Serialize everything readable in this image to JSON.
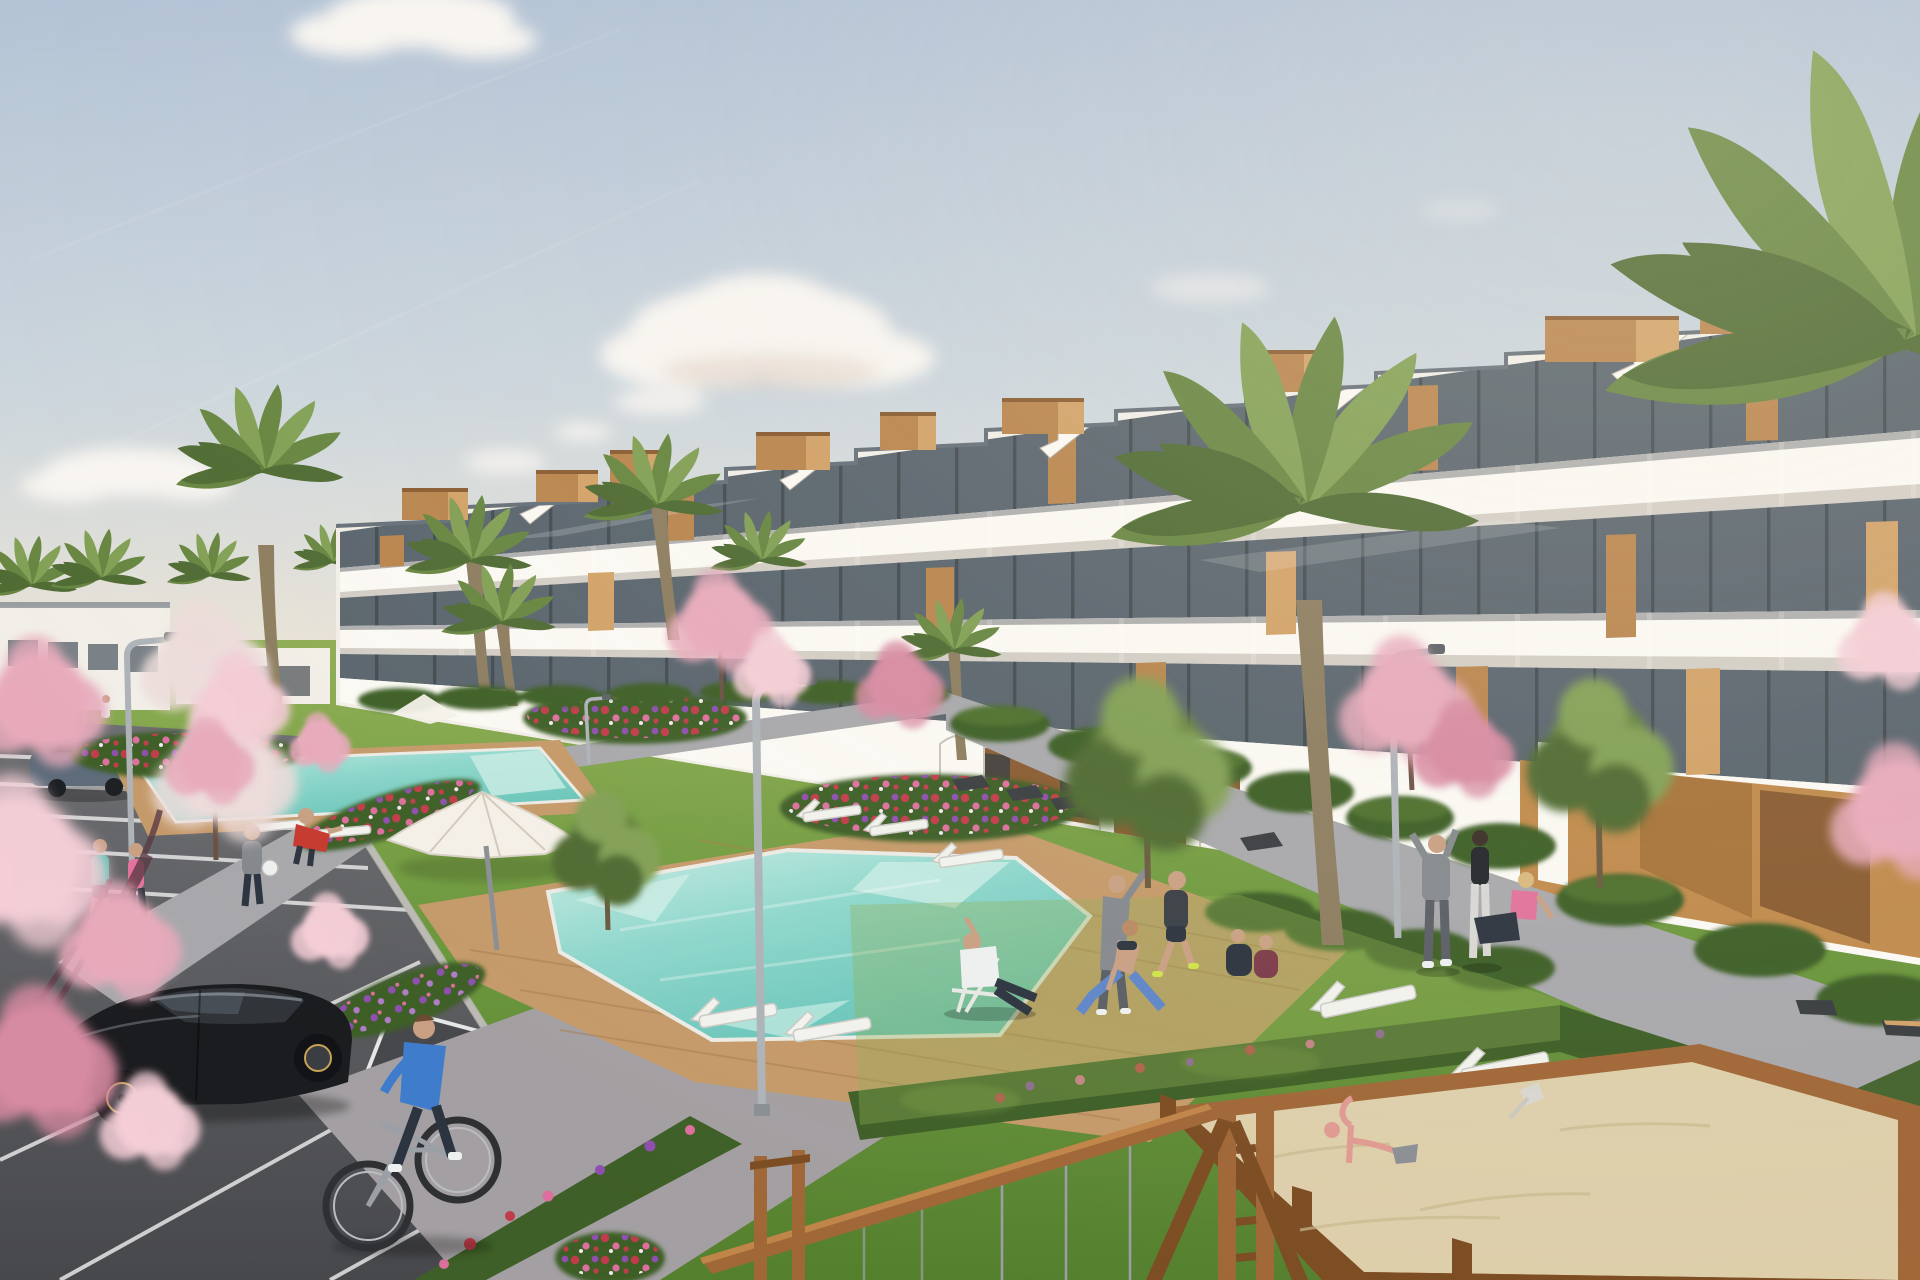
{
  "scene": {
    "type": "architectural-render",
    "objects": {
      "sky": "Clear morning sky",
      "clouds": "Scattered soft clouds",
      "apartments": "White terraced apartment complex with wooden accents",
      "left_buildings": "Distant low residential block",
      "palms": "Palm trees",
      "blossoms": "Pink blossom trees",
      "green_trees": "Garden trees",
      "lawn": "Landscaped lawns",
      "flower_beds": "Flower beds in bloom",
      "hedges": "Trimmed hedges",
      "pool_main": "Main swimming pool",
      "pool_upper": "Second swimming pool",
      "deck": "Wooden pool deck",
      "loungers": "White sun loungers",
      "parasol": "White garden parasol",
      "lamps": "Curved street lamps",
      "benches": "Modern garden benches",
      "promenade": "Pedestrian promenade",
      "plaza": "Paved plaza",
      "parking": "Residents parking lot",
      "black_car": "Black hatchback car",
      "parked_cars": "Parked cars",
      "cyclist": "Man riding a bicycle",
      "joggers": "Two women jogging",
      "ball_players": "Residents playing with a ball",
      "yoga_group": "Residents exercising on the lawn",
      "pool_sitter": "Man relaxing on a deck chair",
      "walkers": "Residents on the promenade",
      "sandbox": "Playground sandbox with toys",
      "swing": "Wooden swing frame",
      "foreground_blossom": "Foreground cherry blossom branches"
    }
  },
  "palette": {
    "sky_top": "#b3c3d6",
    "sky_mid": "#ccd6dd",
    "sky_low": "#e8e3d8",
    "cloud": "#f8f5f1",
    "bld_white": "#f2efe8",
    "bld_white_lit": "#fbf9f4",
    "bld_shadow": "#d9d4cb",
    "bld_deep": "#b2aca1",
    "glass_dark": "#343a40",
    "glass_mid": "#5a656e",
    "glass_lite": "#8b99a3",
    "wood": "#b9854e",
    "wood_lite": "#d2a268",
    "wood_dark": "#8a5c31",
    "roof_edge": "#66707a",
    "tan_wall": "#c08a4c",
    "tan_wall_dark": "#9c6b33",
    "palm_dark": "#4f6b33",
    "palm_mid": "#678641",
    "palm_lite": "#82a055",
    "trunk": "#8d7d60",
    "grass_lite": "#8fae54",
    "grass": "#6f9a3f",
    "grass_dark": "#54802e",
    "hedge": "#3e5f27",
    "hedge_lite": "#5d8136",
    "blossom": "#e7aabb",
    "blossom_lite": "#f3cdd6",
    "blossom_deep": "#d78ba2",
    "blossom_white": "#ecdcda",
    "flower_red": "#c13c4a",
    "flower_pink": "#dd6f9e",
    "flower_purple": "#8e4fae",
    "pool": "#8ed7cc",
    "pool_deep": "#66c3b8",
    "pool_pale": "#c8ece4",
    "pool_edge": "#ecebe5",
    "deck": "#c59a6a",
    "deck_dark": "#a87e4e",
    "path": "#a8a8ac",
    "path_lit": "#bdbdc0",
    "plaza": "#a39fa2",
    "asphalt": "#5b5c60",
    "asphalt_dark": "#47484c",
    "line_white": "#e6e6e6",
    "car_black": "#1b1c1f",
    "car_glass": "#31353a",
    "car_hilite": "#8f969e",
    "rim_gold": "#c8a353",
    "car_blue": "#5d6b7a",
    "car_dark2": "#3c4148",
    "sand": "#decfab",
    "sand_shadow": "#c9b98f",
    "frame_wood": "#a06737",
    "frame_wood_dark": "#7c4c22",
    "lamp": "#aeb3b8",
    "bench_dark": "#3a3d41",
    "skin": "#c9a084",
    "teal_top": "#43bfae",
    "pink_top": "#e2739c",
    "blue_shirt": "#3f7ccc",
    "red_shirt": "#c63a2e",
    "gray_cloth": "#85898e",
    "navy": "#2c343f",
    "maroon": "#7c3b49",
    "white_cloth": "#eef0f0",
    "yellow_shoe": "#cfe24a"
  }
}
